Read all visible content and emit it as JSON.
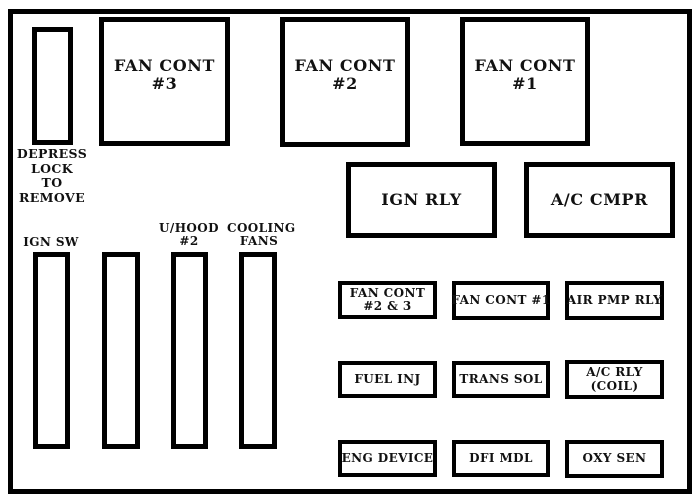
{
  "colors": {
    "line": "#000000",
    "background": "#ffffff",
    "text": "#111111"
  },
  "removal_note": {
    "line1": "DEPRESS",
    "line2": "LOCK",
    "line3": "TO",
    "line4": "REMOVE"
  },
  "large_fuse_boxes": [
    {
      "name": "fan-cont-3",
      "line1": "FAN CONT",
      "line2": "#3"
    },
    {
      "name": "fan-cont-2",
      "line1": "FAN CONT",
      "line2": "#2"
    },
    {
      "name": "fan-cont-1",
      "line1": "FAN CONT",
      "line2": "#1"
    }
  ],
  "relay_boxes": [
    {
      "name": "ign-rly",
      "label": "IGN RLY"
    },
    {
      "name": "ac-cmpr",
      "label": "A/C CMPR"
    }
  ],
  "slot_labels": {
    "ign_sw": "IGN SW",
    "u_hood_line1": "U/HOOD",
    "u_hood_line2": "#2",
    "cooling_line1": "COOLING",
    "cooling_line2": "FANS"
  },
  "mini_boxes": {
    "row1": [
      {
        "name": "fan-cont-2-3",
        "line1": "FAN CONT",
        "line2": "#2 & 3"
      },
      {
        "name": "fan-cont-1-mini",
        "line1": "FAN CONT #1",
        "line2": ""
      },
      {
        "name": "air-pmp-rly",
        "line1": "AIR PMP RLY",
        "line2": ""
      }
    ],
    "row2": [
      {
        "name": "fuel-inj",
        "line1": "FUEL INJ",
        "line2": ""
      },
      {
        "name": "trans-sol",
        "line1": "TRANS SOL",
        "line2": ""
      },
      {
        "name": "ac-rly-coil",
        "line1": "A/C RLY",
        "line2": "(COIL)"
      }
    ],
    "row3": [
      {
        "name": "eng-device",
        "line1": "ENG DEVICE",
        "line2": ""
      },
      {
        "name": "dfi-mdl",
        "line1": "DFI MDL",
        "line2": ""
      },
      {
        "name": "oxy-sen",
        "line1": "OXY SEN",
        "line2": ""
      }
    ]
  }
}
